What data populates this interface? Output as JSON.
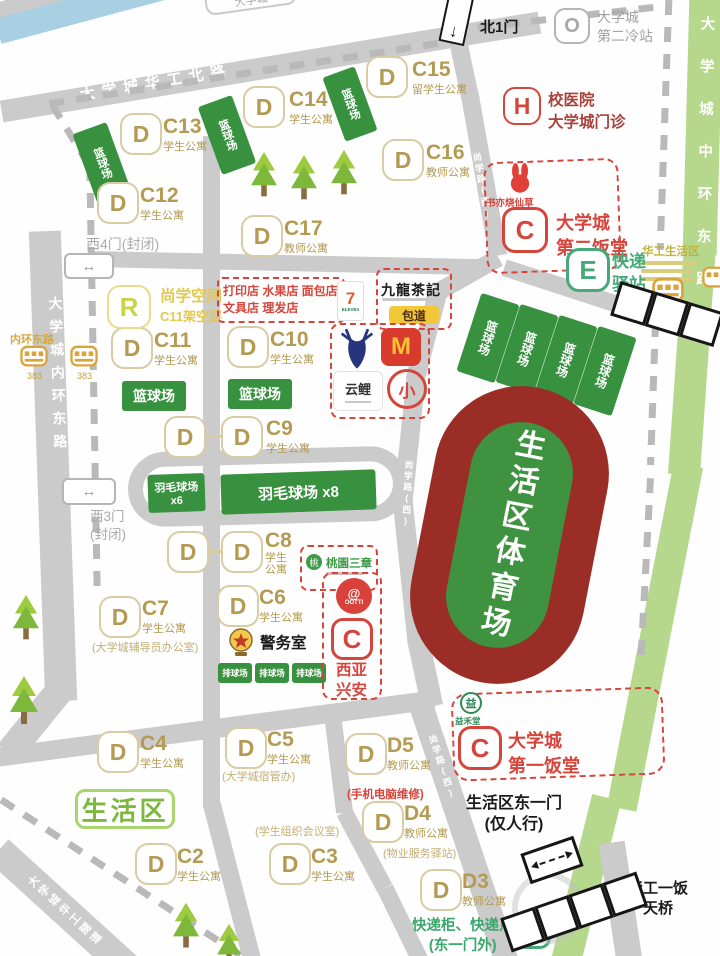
{
  "roads": {
    "north": "大学城华工北路",
    "west": "大学城内环东路",
    "east": "大学城中环东路",
    "inner": "尚学路(西)",
    "sw": "大学城华工隧道",
    "top_box": "大学城"
  },
  "gates": {
    "north1": "北1门",
    "west4": "西4门(封闭)",
    "west3_line1": "西3门",
    "west3_line2": "(封闭)",
    "east1_line1": "生活区东一门",
    "east1_line2": "(仅人行)"
  },
  "icons": {
    "two_way_arrow": "↔",
    "down_arrow": "↓"
  },
  "buildings": [
    {
      "letter": "D",
      "code": "C15",
      "sub": "留学生公寓"
    },
    {
      "letter": "D",
      "code": "C14",
      "sub": "学生公寓"
    },
    {
      "letter": "D",
      "code": "C13",
      "sub": "学生公寓"
    },
    {
      "letter": "D",
      "code": "C16",
      "sub": "教师公寓"
    },
    {
      "letter": "D",
      "code": "C12",
      "sub": "学生公寓"
    },
    {
      "letter": "D",
      "code": "C17",
      "sub": "教师公寓"
    },
    {
      "letter": "D",
      "code": "C11",
      "sub": "学生公寓"
    },
    {
      "letter": "D",
      "code": "C10",
      "sub": "学生公寓"
    },
    {
      "letter": "D",
      "code": "C9",
      "sub": "学生公寓"
    },
    {
      "letter": "D",
      "code": "C8",
      "sub": "学生公寓"
    },
    {
      "letter": "D",
      "code": "C7",
      "sub": "学生公寓",
      "note": "(大学城辅导员办公室)"
    },
    {
      "letter": "D",
      "code": "C6",
      "sub": "学生公寓"
    },
    {
      "letter": "D",
      "code": "C5",
      "sub": "学生公寓",
      "note": "(大学城宿管办)"
    },
    {
      "letter": "D",
      "code": "C4",
      "sub": "学生公寓"
    },
    {
      "letter": "D",
      "code": "C2",
      "sub": "学生公寓"
    },
    {
      "letter": "D",
      "code": "C3",
      "sub": "学生公寓"
    },
    {
      "letter": "D",
      "code": "D5",
      "sub": "教师公寓"
    },
    {
      "letter": "D",
      "code": "D4",
      "sub": "教师公寓"
    },
    {
      "letter": "D",
      "code": "D3",
      "sub": "教师公寓"
    }
  ],
  "notes": {
    "meeting": "(学生组织会议室)",
    "repair": "(手机电脑维修)",
    "property": "(物业服务驿站)"
  },
  "sports": {
    "basketball": "篮球场",
    "badminton6_l1": "羽毛球场",
    "badminton6_l2": "x6",
    "badminton8": "羽毛球场 x8",
    "volleyball": "排球场",
    "stadium": "生活区体育场"
  },
  "facilities": {
    "study": {
      "letter": "R",
      "l1": "尚学空间",
      "l2": "C11架空层"
    },
    "hospital": {
      "letter": "H",
      "l1": "校医院",
      "l2": "大学城门诊"
    },
    "cold": {
      "letter": "O",
      "l1": "大学城",
      "l2": "第二冷站"
    },
    "canteen2": {
      "letter": "C",
      "l1": "大学城",
      "l2": "第二饭堂"
    },
    "canteen1": {
      "letter": "C",
      "l1": "大学城",
      "l2": "第一饭堂"
    },
    "express": {
      "letter": "E",
      "l1": "快递",
      "l2": "驿站"
    },
    "lockers": {
      "letter": "E",
      "l1": "快递柜、快递点",
      "l2": "(东一门外)"
    },
    "police": "警务室",
    "xiya": {
      "letter": "C",
      "l1": "西亚",
      "l2": "兴安"
    },
    "living": "生活区",
    "bridge_l1": "华工一饭",
    "bridge_l2": "天桥"
  },
  "shops": {
    "printrow_l1": "打印店 水果店 面包店",
    "printrow_l2": "文具店 理发店",
    "seven": "7",
    "seven_sub": "ELEVEn",
    "tea": "九龍茶記",
    "bao": "包道",
    "mcd": "M",
    "yunli": "云鲤",
    "xiao": "小",
    "shuyi": "书亦烧仙草",
    "taoyuan": "桃園三章",
    "taoyuan_icon": "桃",
    "ootti": "OOTTI",
    "ootti_mark": "@",
    "yihetang": "益禾堂",
    "yihetang_icon": "益"
  },
  "bus": {
    "stop_west": "内环东路",
    "route": "383",
    "stop_east": "华工生活区"
  }
}
